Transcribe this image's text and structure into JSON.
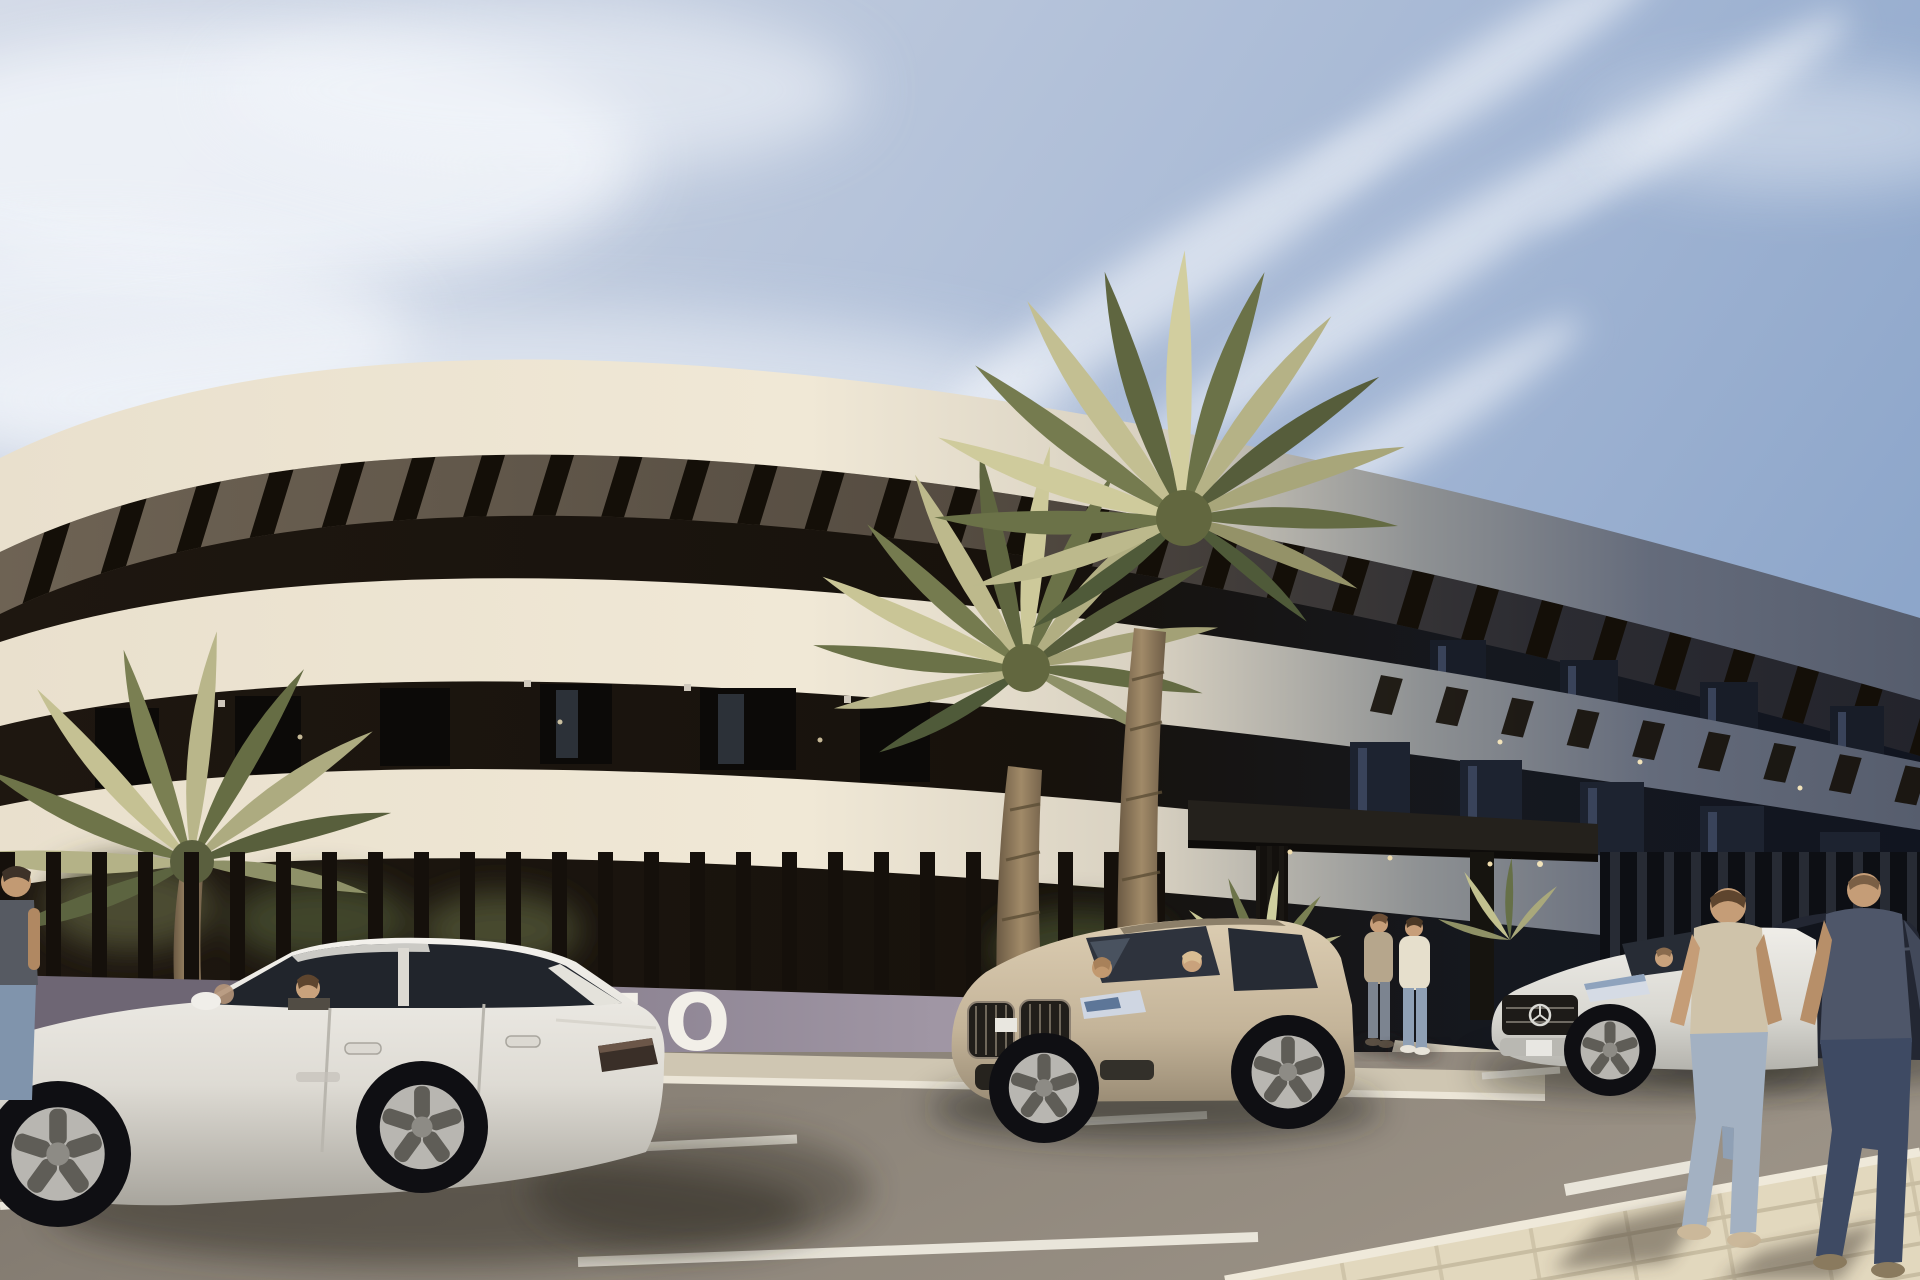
{
  "meta": {
    "domain": "architectural exterior rendering",
    "description": "Sunny photorealistic render of a curved three-storey apartment building with cream balcony bands, dark recessed window strips, rooftop pergola slats, palm trees, a slatted boundary fence, parked cars and pedestrians on the street in front.",
    "image_width_px": 1920,
    "image_height_px": 1280
  },
  "sign": {
    "text": "TO",
    "note": "white capital letters on the low boundary wall, partially hidden behind the parked white sedan"
  },
  "building": {
    "label": "curved modern apartment building",
    "storeys_visible": 3,
    "features": [
      "curved cream balcony fascias",
      "dark recessed window bands",
      "rooftop pergola slat beams",
      "dark flat entrance canopy on slatted pillars",
      "vertical-slat boundary fence on low wall",
      "soffit downlights along shaded right wing"
    ]
  },
  "scene": {
    "sky": {
      "label": "pale blue sky with diagonal wispy cirrus clouds",
      "light": "sunlight from the upper right"
    },
    "road": {
      "label": "asphalt street in front of the building",
      "markings": [
        "white dashed lane lines",
        "solid white edge line"
      ],
      "sidewalk": "cream block paving running diagonally through the right foreground"
    },
    "vehicles": [
      {
        "label": "white sedan parked at kerb with driver and rear passenger",
        "color": "#e9e7e1",
        "position": "left foreground"
      },
      {
        "label": "champagne-beige SUV with two occupants",
        "color": "#cdbda1",
        "position": "centre at kerb"
      },
      {
        "label": "white Mercedes sedan with driver",
        "color": "#e4e2dc",
        "position": "right of entrance"
      },
      {
        "label": "dark navy sedan partially hidden behind pedestrians",
        "color": "#232733",
        "position": "far right"
      }
    ],
    "people": [
      {
        "label": "person in dark top and jeans",
        "position": "far left edge, partly out of frame"
      },
      {
        "label": "man in beige cardigan",
        "position": "standing at entrance"
      },
      {
        "label": "man in cream sweater and blue jeans",
        "position": "standing at entrance"
      },
      {
        "label": "man walking away in tan t-shirt and light jeans",
        "position": "right foreground sidewalk"
      },
      {
        "label": "man walking away in dark blue t-shirt and dark jeans",
        "position": "far right foreground"
      }
    ],
    "vegetation": [
      {
        "label": "large date palm",
        "position": "centre courtyard"
      },
      {
        "label": "taller date palm",
        "position": "centre-right courtyard"
      },
      {
        "label": "palm crown behind fence",
        "position": "far left"
      },
      {
        "label": "yucca shrubs",
        "position": "by entrance and along the fence"
      }
    ]
  },
  "colors": {
    "sky_top": "#8fa6ca",
    "sky_light": "#ccd5e4",
    "cloud": "#f2f5fa",
    "band_sunlit": "#ece3d1",
    "band_shaded": "#5d6474",
    "recess_dark": "#171210",
    "recess_shaded": "#141821",
    "pergola_slat": "#140f0a",
    "canopy": "#23201b",
    "fence_bar": "#15100b",
    "wall_mauve": "#978e9c",
    "wall_shadow": "#6e6674",
    "sidewalk": "#d9cfb8",
    "paver_joint": "#c6bba1",
    "asphalt": "#8d857a",
    "road_marking": "#e9e5da",
    "palm_light": "#cac69a",
    "palm_mid": "#8e9168",
    "palm_dark": "#4f5a39",
    "palm_trunk": "#97805f",
    "sign_text": "#f2efe8"
  }
}
